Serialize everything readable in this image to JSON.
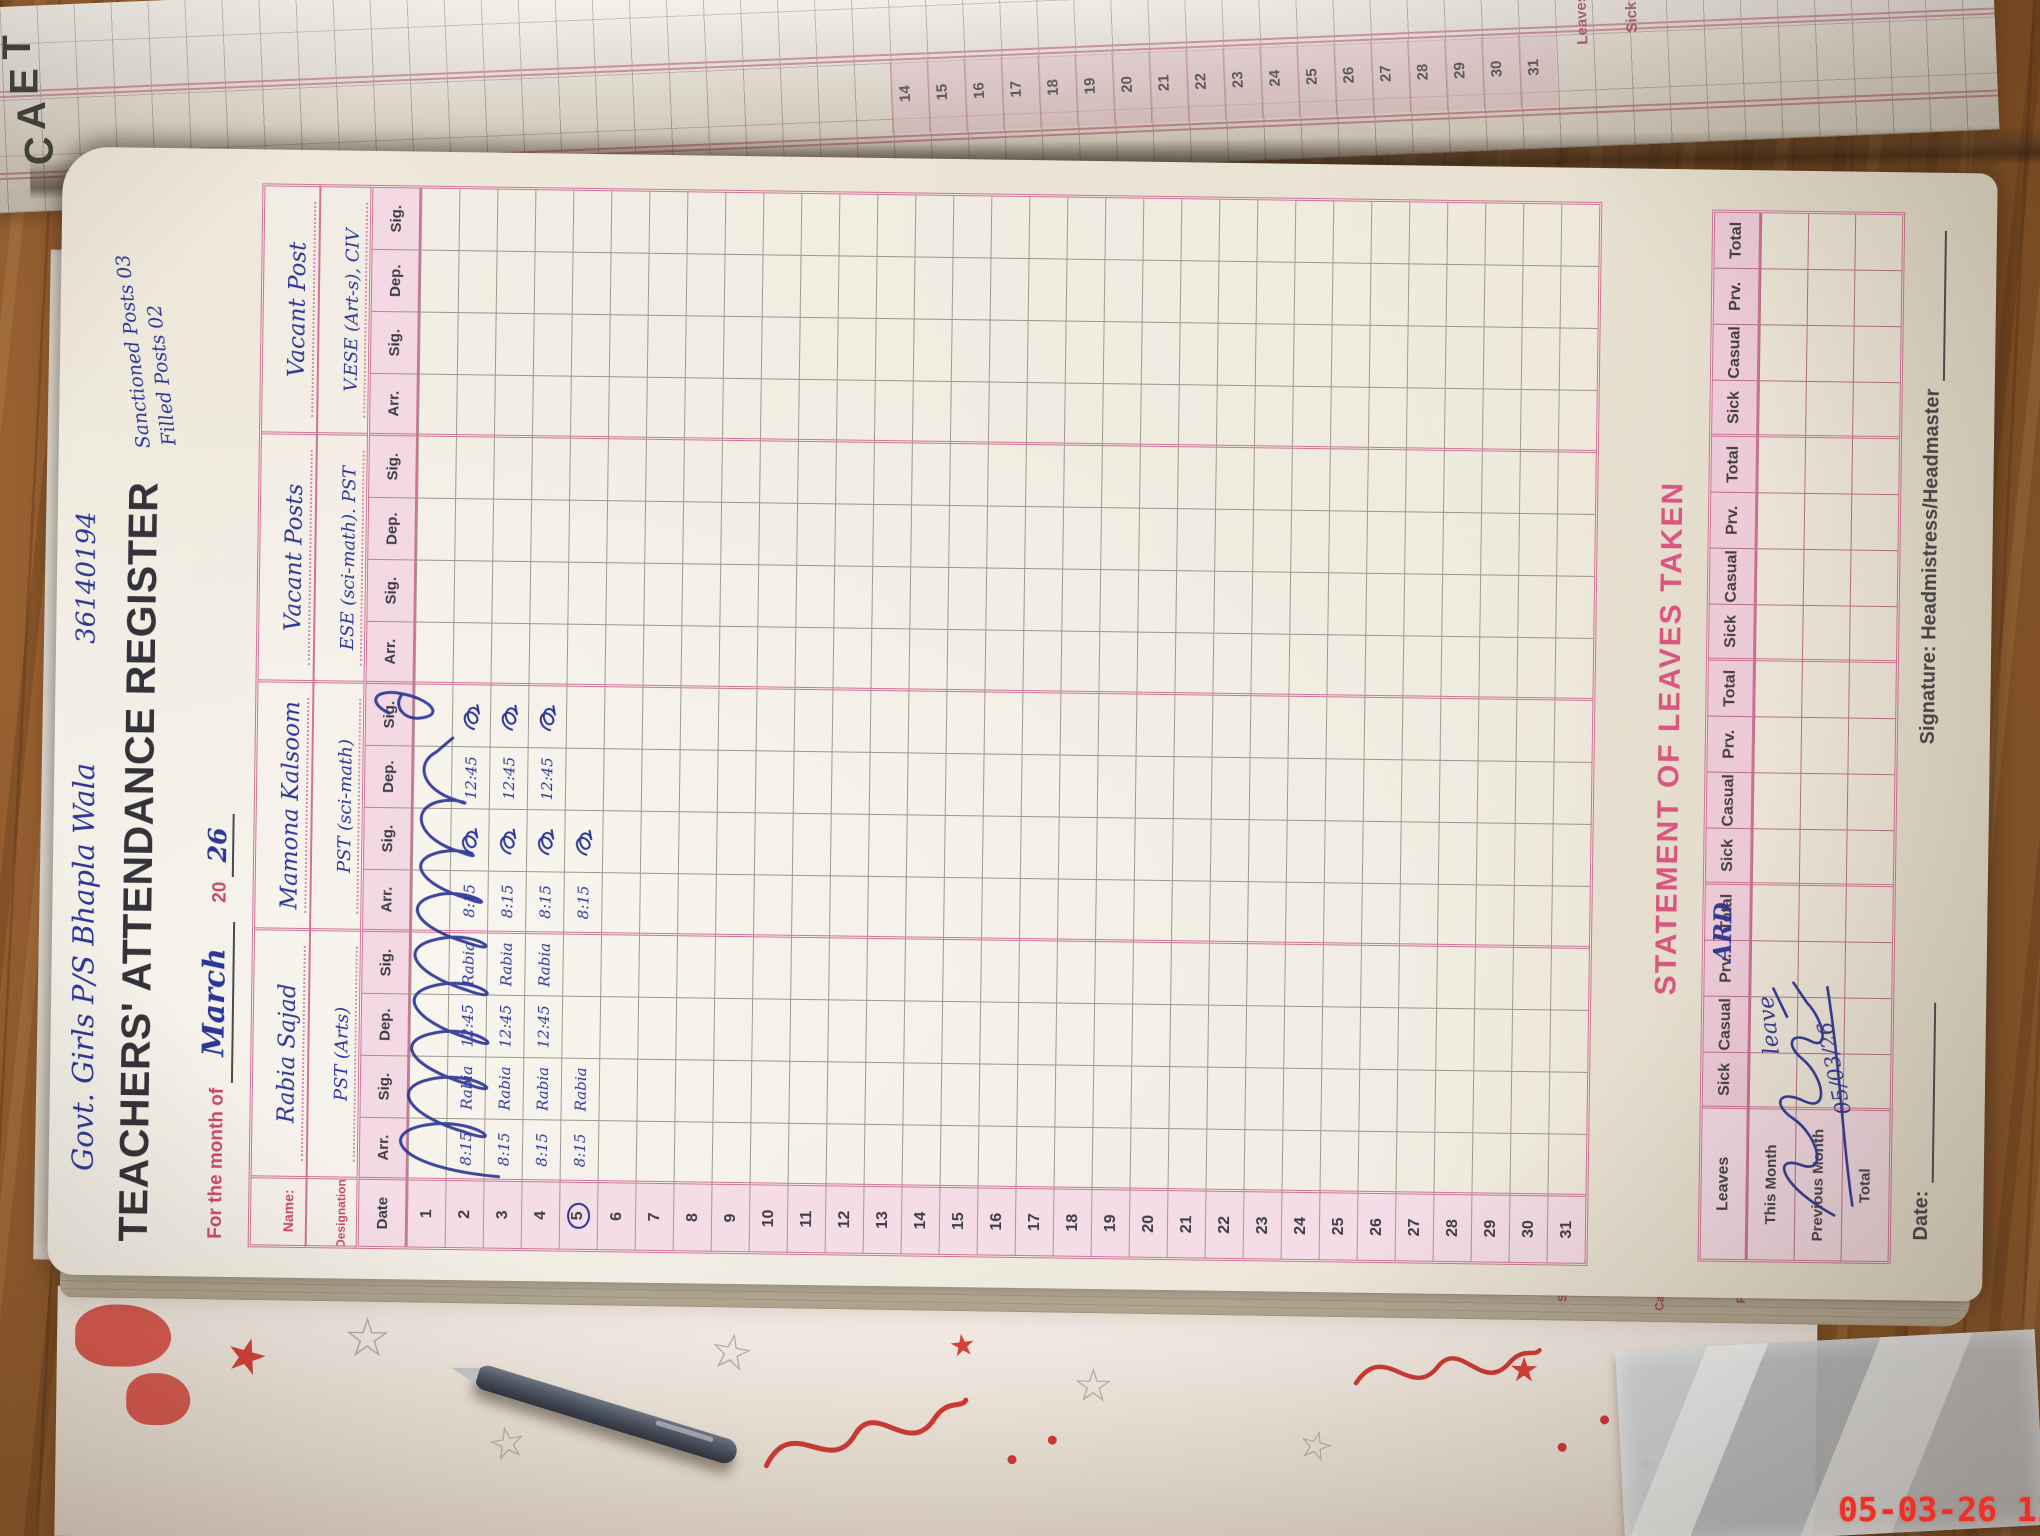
{
  "scene": {
    "timestamp": "05-03-26 11:00",
    "cover_letters": "TEAC"
  },
  "facing_page": {
    "dates": [
      14,
      15,
      16,
      17,
      18,
      19,
      20,
      21,
      22,
      23,
      24,
      25,
      26,
      27,
      28,
      29,
      30,
      31
    ],
    "edge_labels": [
      "Leaves",
      "Sick"
    ]
  },
  "peek_labels": [
    "Sick",
    "Casual",
    "Prv."
  ],
  "register": {
    "school_name": "Govt. Girls P/S Bhapla Wala",
    "emis_code": "36140194",
    "title": "TEACHERS' ATTENDANCE REGISTER",
    "sanctioned_note": "Sanctioned Posts 03",
    "filled_note": "Filled Posts 02",
    "month": {
      "label": "For the month of",
      "value": "March",
      "year_prefix": "20",
      "year_value": "26"
    },
    "name_label": "Name:",
    "designation_label": "Designation:",
    "teachers": [
      {
        "name": "Rabia Sajad",
        "designation": "PST (Arts)"
      },
      {
        "name": "Mamona Kalsoom",
        "designation": "PST (sci-math)"
      },
      {
        "name": "Vacant Posts",
        "designation": "ESE (sci-math). PST"
      },
      {
        "name": "Vacant Post",
        "designation": "V.ESE (Art-s), CIV"
      }
    ],
    "attendance": {
      "date_header": "Date",
      "sub_headers": [
        "Arr.",
        "Sig.",
        "Dep.",
        "Sig."
      ],
      "days": 31,
      "circled_date": 5,
      "entries": {
        "2": {
          "t1": [
            "8:15",
            "Rabia",
            "12:45",
            "Rabia"
          ],
          "t2": [
            "8:15",
            "~",
            "12:45",
            "~"
          ]
        },
        "3": {
          "t1": [
            "8:15",
            "Rabia",
            "12:45",
            "Rabia"
          ],
          "t2": [
            "8:15",
            "~",
            "12:45",
            "~"
          ]
        },
        "4": {
          "t1": [
            "8:15",
            "Rabia",
            "12:45",
            "Rabia"
          ],
          "t2": [
            "8:15",
            "~",
            "12:45",
            "~"
          ]
        },
        "5": {
          "t1": [
            "8:15",
            "Rabia",
            "",
            ""
          ],
          "t2": [
            "8:15",
            "~",
            "",
            ""
          ]
        }
      }
    },
    "leaves": {
      "title": "STATEMENT OF LEAVES TAKEN",
      "corner_label": "Leaves",
      "col_headers": [
        "Sick",
        "Casual",
        "Prv.",
        "Total"
      ],
      "row_labels": [
        "This Month",
        "Previous Month",
        "Total"
      ],
      "notes": {
        "word1": "ARD",
        "word2": "leave",
        "date": "05/03/26"
      }
    },
    "footer": {
      "date_label": "Date:",
      "signature_label": "Signature: Headmistress/Headmaster"
    }
  }
}
